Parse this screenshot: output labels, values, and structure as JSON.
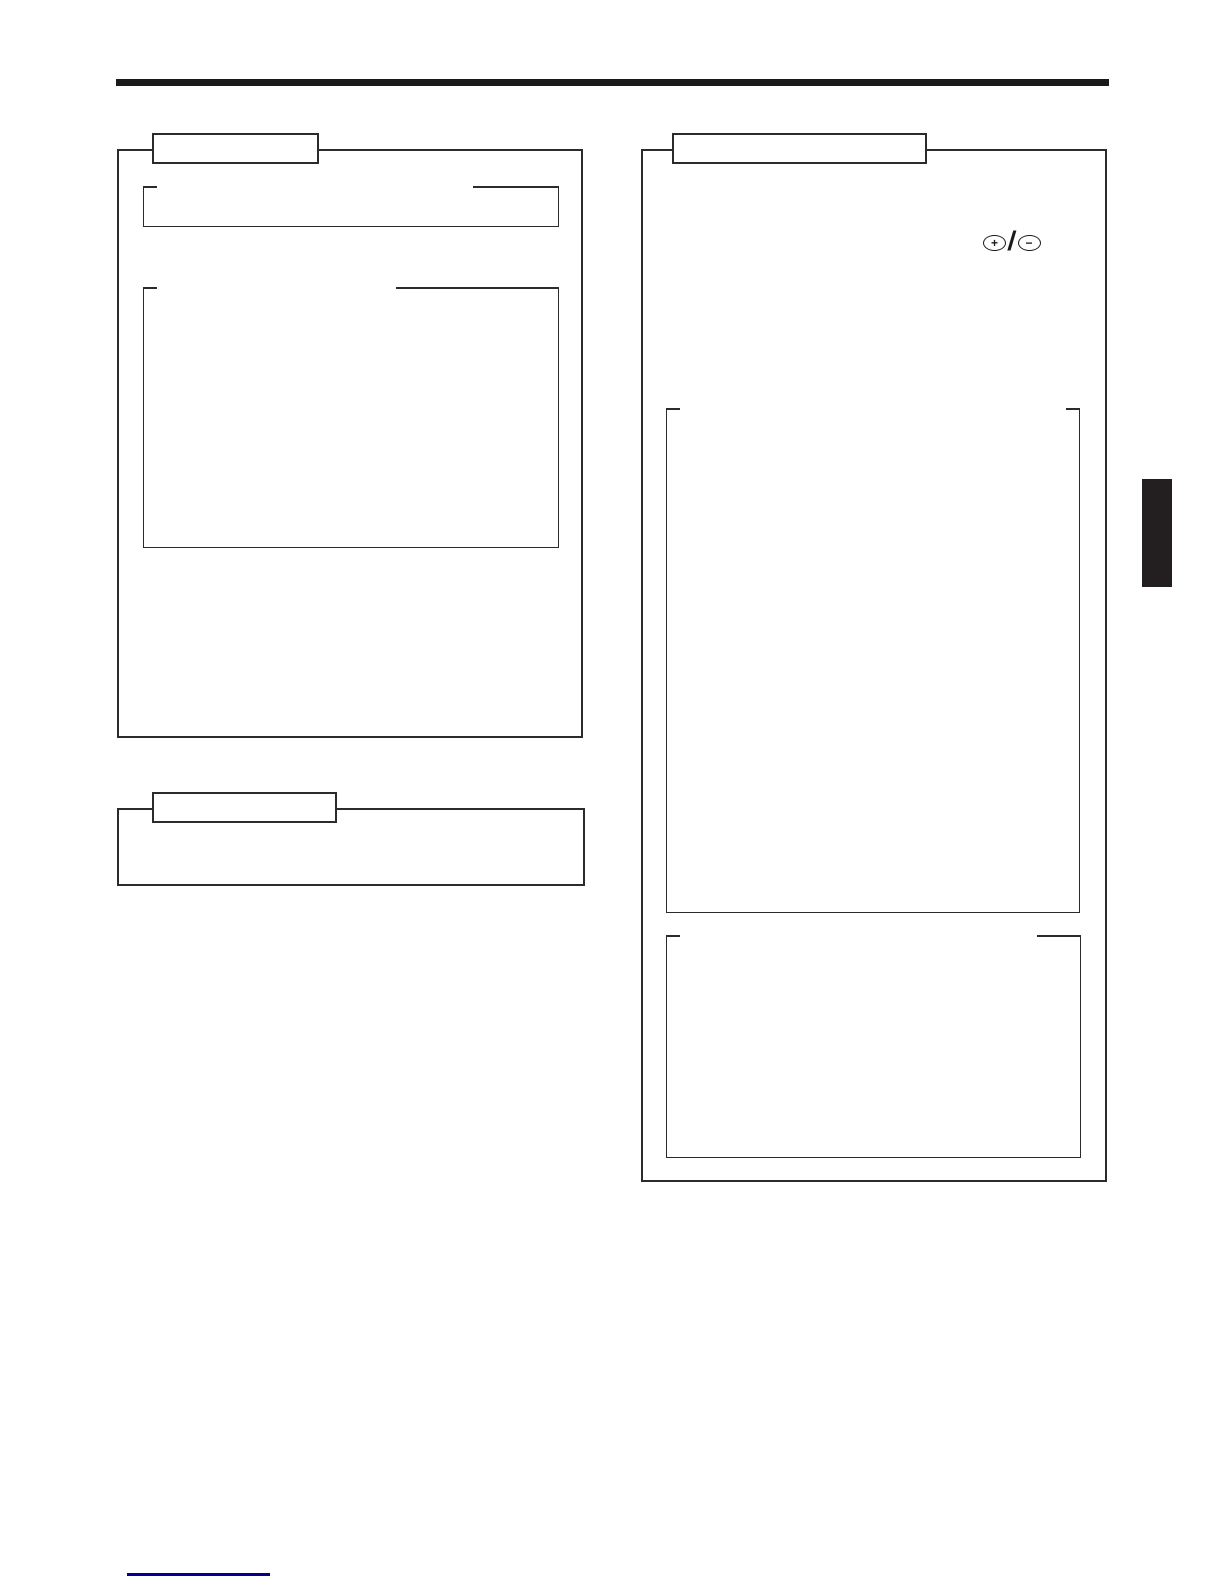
{
  "icons": {
    "plus_glyph": "+",
    "minus_glyph": "−",
    "separator_glyph": "/"
  },
  "colors": {
    "header_rule": "#1a1a1a",
    "box_line": "#2b2b2b",
    "chapter_tab": "#231f20",
    "footer_line": "#00008b"
  }
}
